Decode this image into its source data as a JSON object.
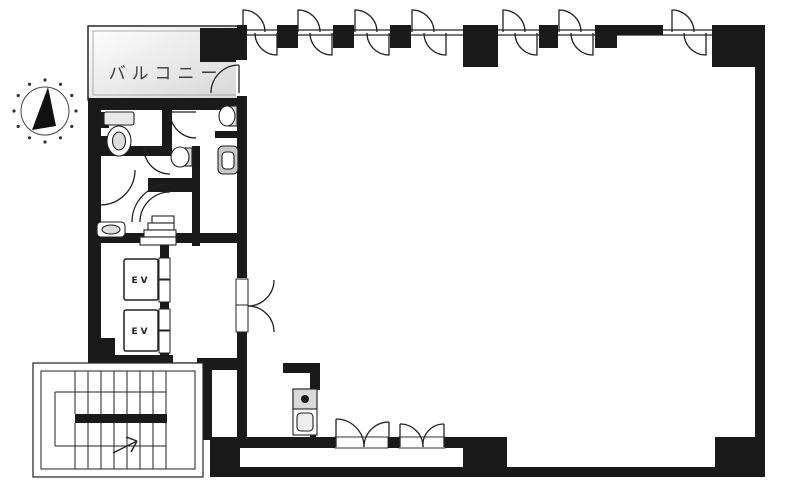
{
  "title": "building-floor-plan",
  "labels": {
    "balcony": "バルコニー",
    "elevator_1": "EV",
    "elevator_2": "EV"
  },
  "colors": {
    "wall": "#1a1a1a",
    "background": "#ffffff",
    "balcony_fill": "#d6d6d6",
    "fixture_gray": "#cfcfcf",
    "line": "#222222"
  },
  "icons": {
    "compass": "north-arrow-icon",
    "stair_direction": "up-arrow-icon",
    "windows": "casement-window-icon",
    "doors": "door-swing-icon"
  }
}
